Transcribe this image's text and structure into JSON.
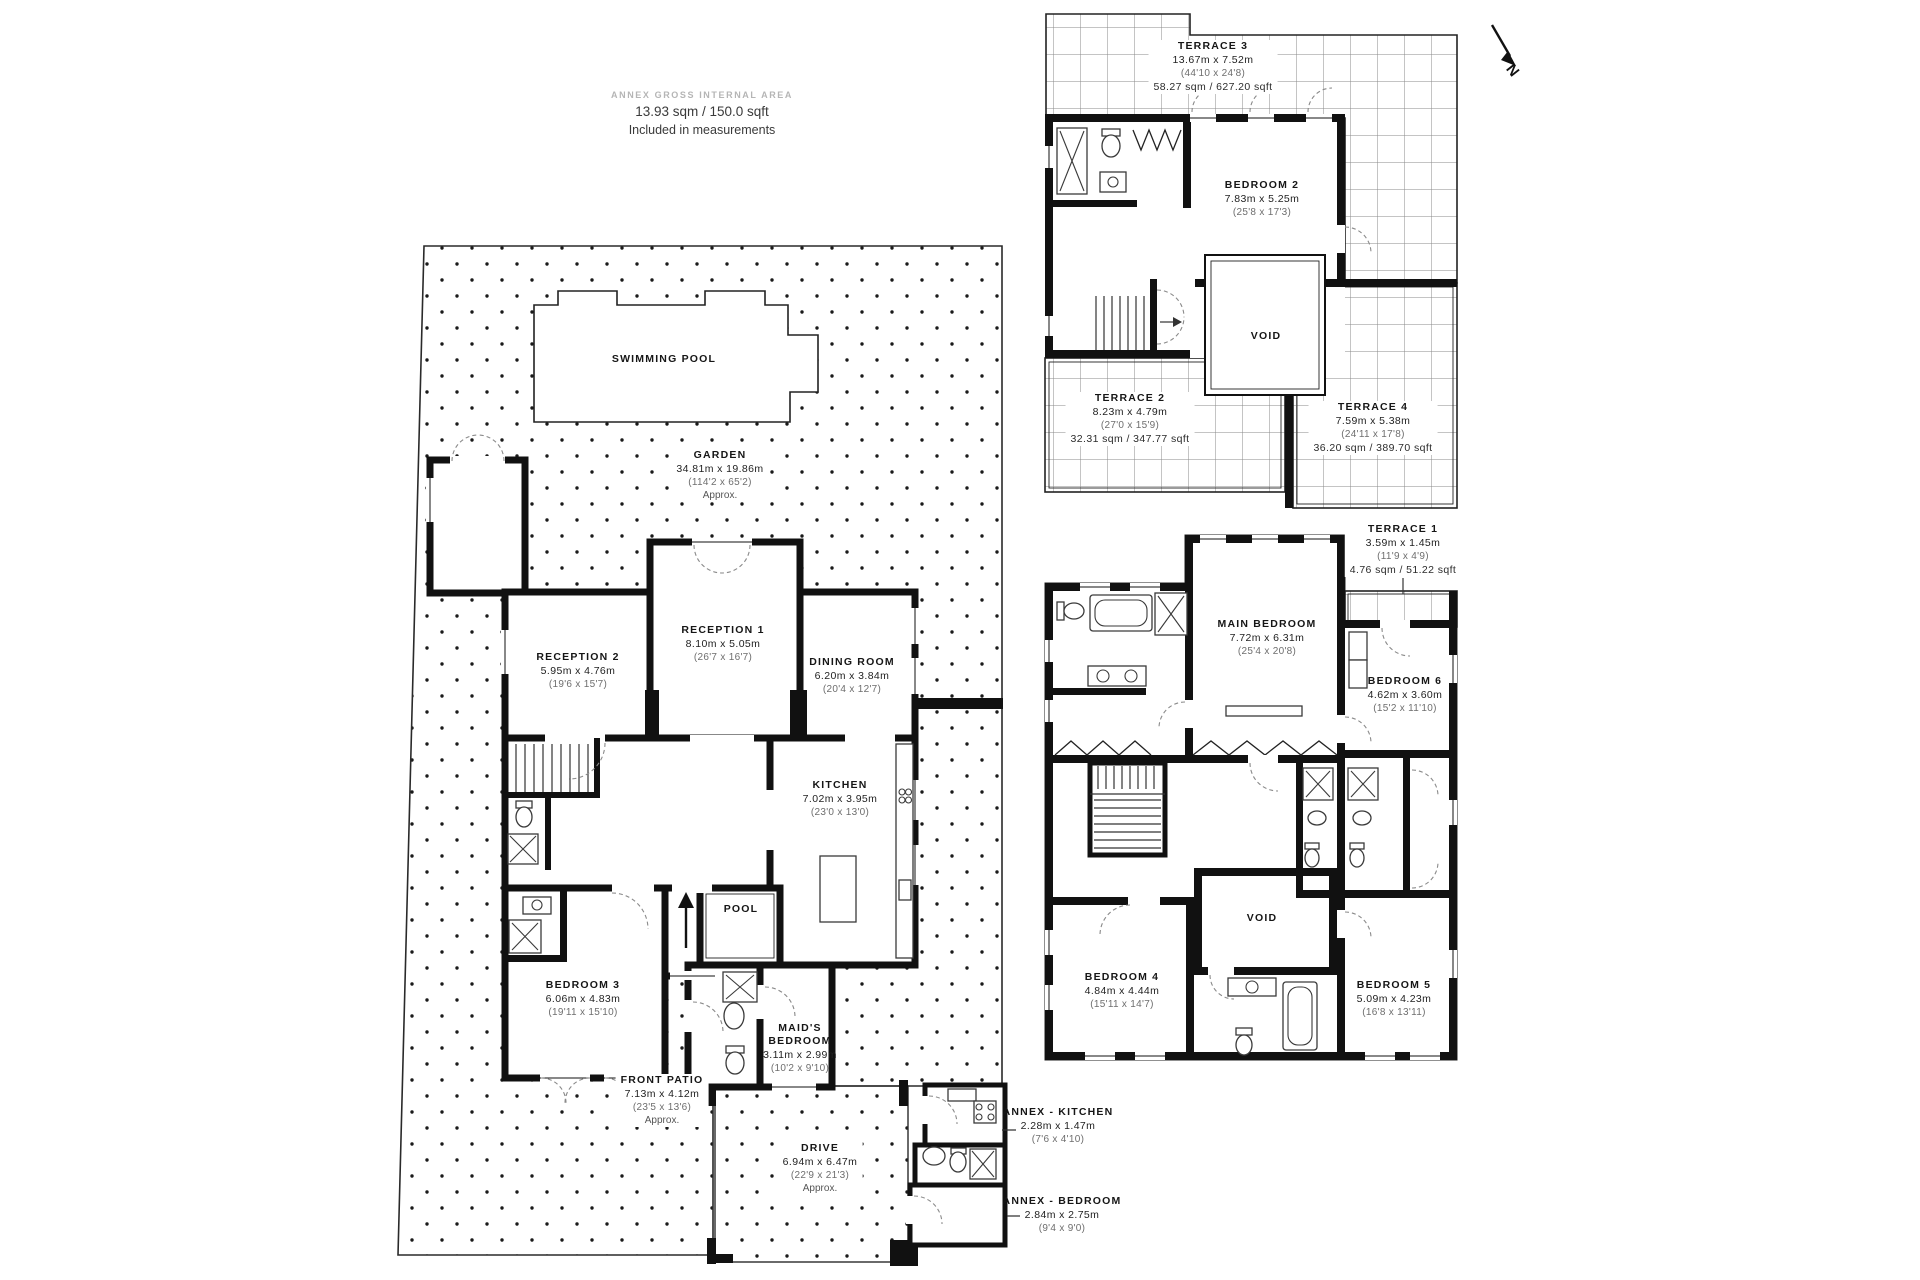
{
  "header": {
    "title": "ANNEX GROSS INTERNAL AREA",
    "line1": "13.93 sqm / 150.0 sqft",
    "line2": "Included in measurements"
  },
  "compass": {
    "label": "N"
  },
  "colors": {
    "walls": "#111111",
    "paper": "#ffffff",
    "dots": "#1a1a1a",
    "grid_line": "#8a8a8a",
    "dim_text": "#222222",
    "secondary_text": "#6e6e6e",
    "header_title": "#b5b5b5"
  },
  "rooms": {
    "garden": {
      "name": "GARDEN",
      "dims": "34.81m x 19.86m",
      "ft": "(114'2 x 65'2)",
      "note": "Approx."
    },
    "swimming_pool": {
      "name": "SWIMMING POOL"
    },
    "reception1": {
      "name": "RECEPTION 1",
      "dims": "8.10m x 5.05m",
      "ft": "(26'7 x 16'7)"
    },
    "reception2": {
      "name": "RECEPTION 2",
      "dims": "5.95m x 4.76m",
      "ft": "(19'6 x 15'7)"
    },
    "dining_room": {
      "name": "DINING ROOM",
      "dims": "6.20m x 3.84m",
      "ft": "(20'4 x 12'7)"
    },
    "kitchen": {
      "name": "KITCHEN",
      "dims": "7.02m x 3.95m",
      "ft": "(23'0 x 13'0)"
    },
    "pool": {
      "name": "POOL"
    },
    "bedroom3": {
      "name": "BEDROOM 3",
      "dims": "6.06m x 4.83m",
      "ft": "(19'11 x 15'10)"
    },
    "maids_bedroom": {
      "name": "MAID'S BEDROOM",
      "dims": "3.11m x 2.99m",
      "ft": "(10'2 x 9'10)"
    },
    "front_patio": {
      "name": "FRONT PATIO",
      "dims": "7.13m x 4.12m",
      "ft": "(23'5 x 13'6)",
      "note": "Approx."
    },
    "drive": {
      "name": "DRIVE",
      "dims": "6.94m x 6.47m",
      "ft": "(22'9 x 21'3)",
      "note": "Approx."
    },
    "annex_kitchen": {
      "name": "ANNEX - KITCHEN",
      "dims": "2.28m x 1.47m",
      "ft": "(7'6 x 4'10)"
    },
    "annex_bedroom": {
      "name": "ANNEX - BEDROOM",
      "dims": "2.84m x 2.75m",
      "ft": "(9'4 x 9'0)"
    },
    "terrace1": {
      "name": "TERRACE 1",
      "dims": "3.59m x 1.45m",
      "ft": "(11'9 x 4'9)",
      "area": "4.76 sqm / 51.22 sqft"
    },
    "terrace2": {
      "name": "TERRACE 2",
      "dims": "8.23m x 4.79m",
      "ft": "(27'0 x 15'9)",
      "area": "32.31 sqm / 347.77 sqft"
    },
    "terrace3": {
      "name": "TERRACE 3",
      "dims": "13.67m x 7.52m",
      "ft": "(44'10 x 24'8)",
      "area": "58.27 sqm / 627.20 sqft"
    },
    "terrace4": {
      "name": "TERRACE 4",
      "dims": "7.59m x 5.38m",
      "ft": "(24'11 x 17'8)",
      "area": "36.20 sqm / 389.70 sqft"
    },
    "bedroom2": {
      "name": "BEDROOM 2",
      "dims": "7.83m x 5.25m",
      "ft": "(25'8 x 17'3)"
    },
    "main_bedroom": {
      "name": "MAIN BEDROOM",
      "dims": "7.72m x 6.31m",
      "ft": "(25'4 x 20'8)"
    },
    "bedroom4": {
      "name": "BEDROOM 4",
      "dims": "4.84m x 4.44m",
      "ft": "(15'11 x 14'7)"
    },
    "bedroom5": {
      "name": "BEDROOM 5",
      "dims": "5.09m x 4.23m",
      "ft": "(16'8 x 13'11)"
    },
    "bedroom6": {
      "name": "BEDROOM 6",
      "dims": "4.62m x 3.60m",
      "ft": "(15'2 x 11'10)"
    },
    "void_second_floor": {
      "name": "VOID"
    },
    "void_first_floor": {
      "name": "VOID"
    }
  }
}
